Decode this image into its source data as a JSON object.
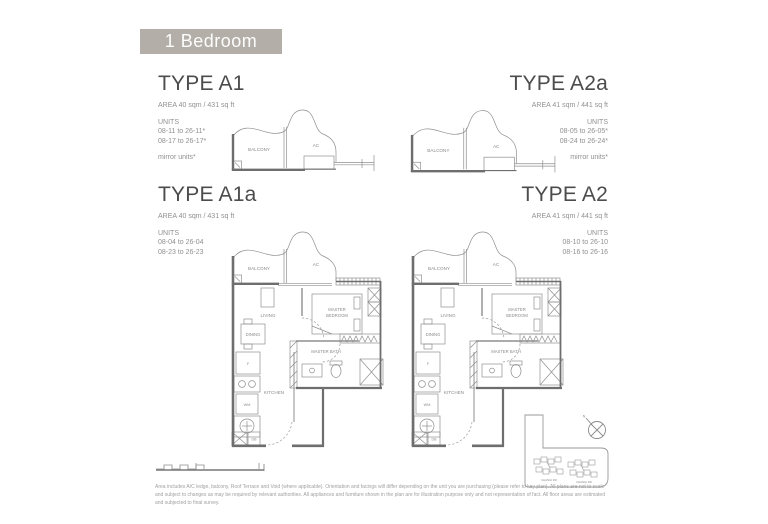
{
  "page": {
    "header_badge": "1 Bedroom"
  },
  "types": {
    "a1": {
      "name": "TYPE A1",
      "area": "AREA  40 sqm / 431 sq ft",
      "units_label": "UNITS",
      "units": [
        "08-11 to 26-11*",
        "08-17 to 26-17*"
      ],
      "note": "mirror units*"
    },
    "a2a": {
      "name": "TYPE A2a",
      "area": "AREA  41 sqm / 441 sq ft",
      "units_label": "UNITS",
      "units": [
        "08-05 to 26-05*",
        "08-24 to 26-24*"
      ],
      "note": "mirror units*"
    },
    "a1a": {
      "name": "TYPE A1a",
      "area": "AREA  40 sqm / 431 sq ft",
      "units_label": "UNITS",
      "units": [
        "08-04 to 26-04",
        "08-23 to 26-23"
      ],
      "note": ""
    },
    "a2": {
      "name": "TYPE A2",
      "area": "AREA  41 sqm / 441 sq ft",
      "units_label": "UNITS",
      "units": [
        "08-10 to 26-10",
        "08-16 to 26-16"
      ],
      "note": ""
    }
  },
  "plan_labels": {
    "balcony": "BALCONY",
    "ac": "AC",
    "living": "LIVING",
    "dining": "DINING",
    "master": "MASTER",
    "bedroom": "BEDROOM",
    "master_bath": "MASTER BATH",
    "kitchen": "KITCHEN",
    "fridge": "F",
    "washer": "WM",
    "db": "DB"
  },
  "keyplan": {
    "north": "N",
    "road_left": "CHANGI RD",
    "road_right": "CHANGI RD"
  },
  "footer": {
    "disclaimer": "Area includes A/C ledge, balcony, Roof Terrace and Void (where applicable). Orientation and facings will differ depending on the unit you are purchasing (please refer to key plan). All plans are not to scale and subject to changes as may be required by relevant authorities. All appliances and furniture shown in the plan are for illustration purpose only and not representation of fact. All floor areas are estimated and subjected to final survey."
  },
  "colors": {
    "badge_bg": "#b3afa8",
    "wall": "#6e6e6e",
    "thin_line": "#8f8f8f",
    "heading": "#4c4c4c"
  }
}
